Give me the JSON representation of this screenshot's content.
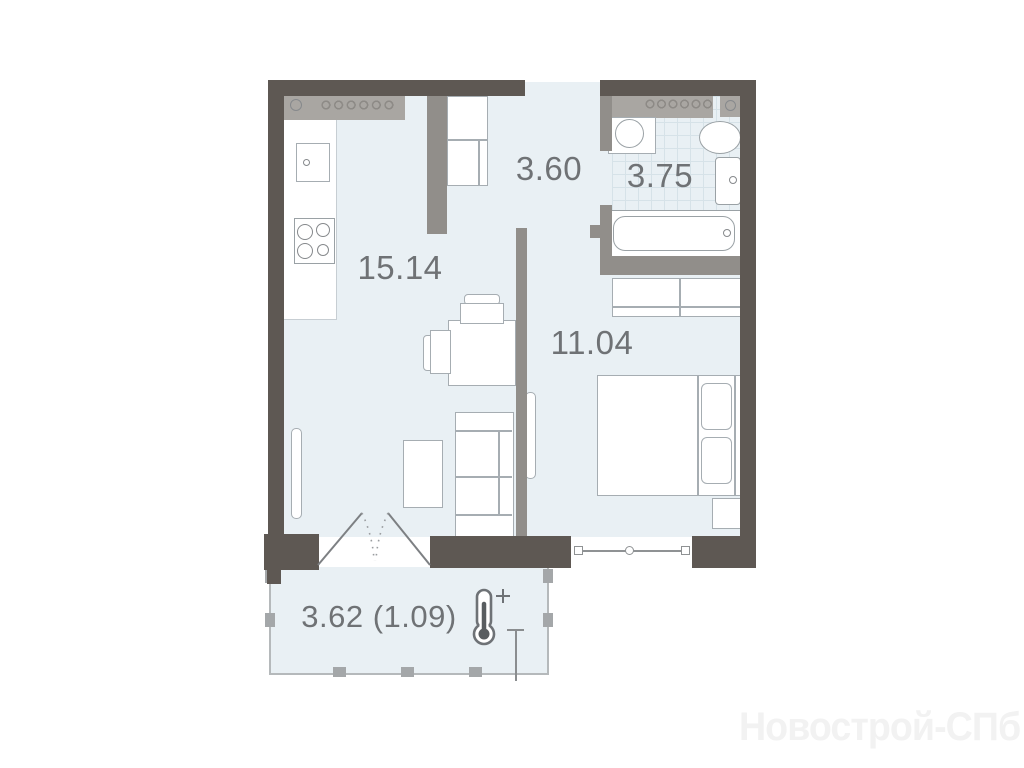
{
  "plan": {
    "title_note": "one-room apartment floor plan",
    "watermark": "Новострой-СПб",
    "rooms": {
      "kitchen_living": {
        "area": "15.14"
      },
      "hallway": {
        "area": "3.60"
      },
      "bathroom": {
        "area": "3.75"
      },
      "bedroom": {
        "area": "11.04"
      },
      "balcony": {
        "area": "3.62 (1.09)"
      }
    },
    "icons": {
      "thermometer_plus": "thermometer-plus-icon (heated balcony)"
    },
    "colors": {
      "outer_wall": "#5e5853",
      "partition": "#918e8a",
      "floor": "#e9f0f4",
      "tile_line": "#d6e2e8",
      "hatch_band": "#a9a6a2",
      "furniture_outline": "#a6adb2",
      "label_text": "#6f7275",
      "watermark_text": "#f2f2f2"
    }
  }
}
